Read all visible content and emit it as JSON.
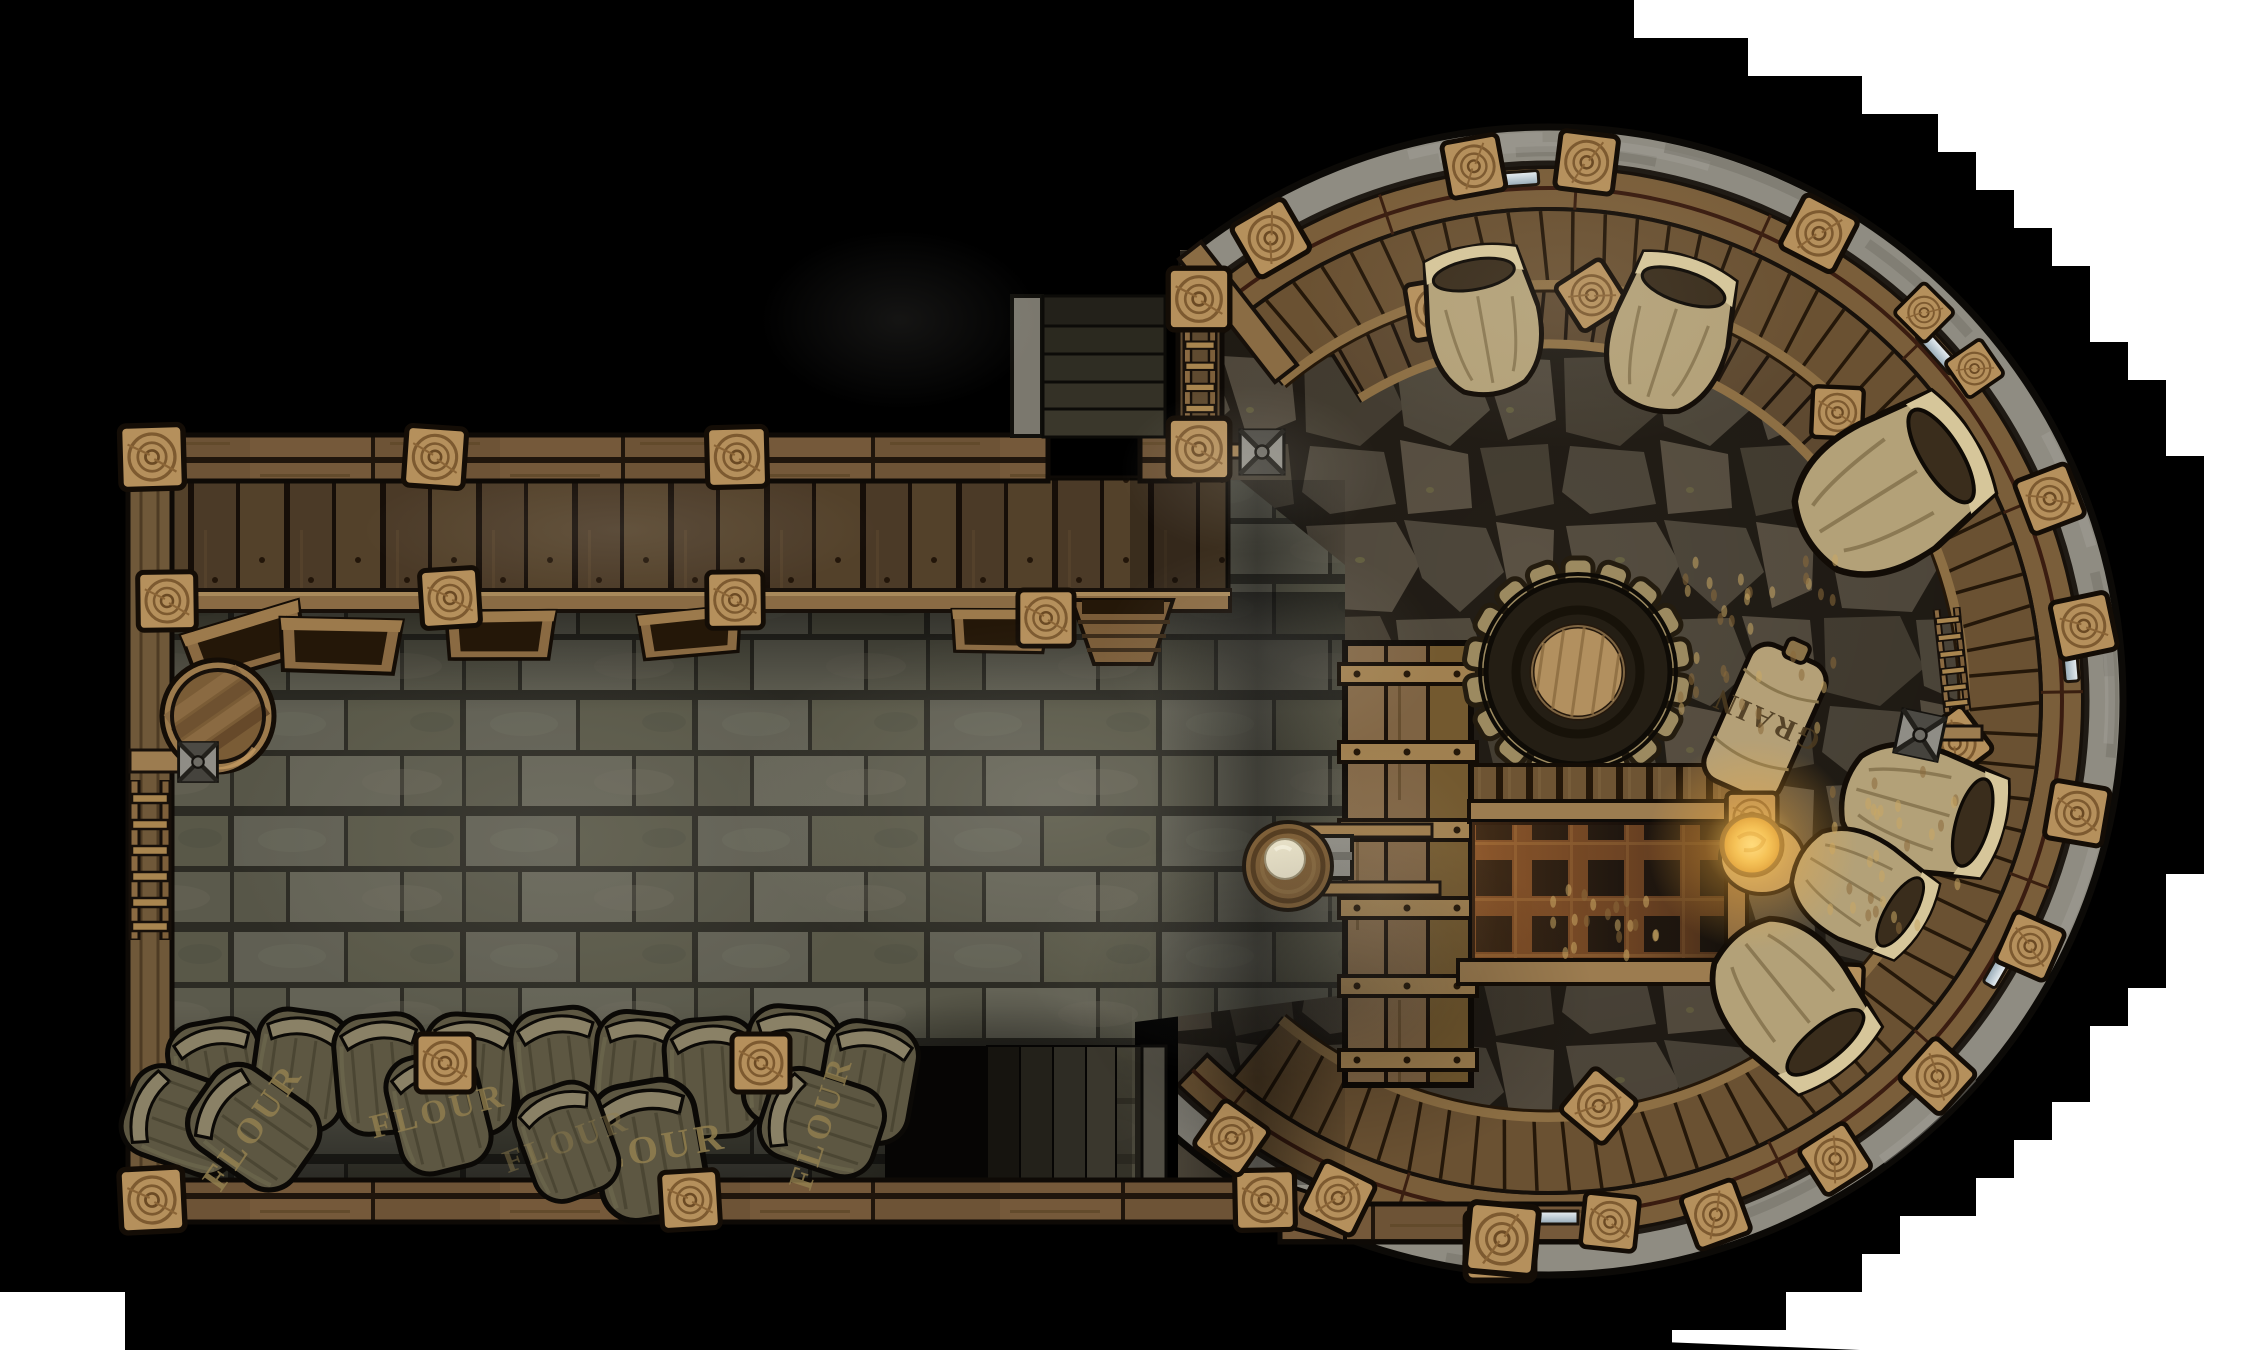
{
  "canvas": {
    "width": 2250,
    "height": 1350,
    "outside_color": "#ffffff",
    "shadow_color": "#000000"
  },
  "labels": {
    "flour": "FLOUR",
    "grain": "GRAIN"
  },
  "palette": {
    "brick_floor": "#5e5d50",
    "brick_mortar": "#2c2b24",
    "flagstone": "#4e473b",
    "flag_joint": "#221d16",
    "wood_light": "#b5905c",
    "wood_mid": "#75593a",
    "wood_dark": "#4e3b26",
    "stone_wall": "#8f8c82",
    "metal": "#8f8d86",
    "grate_rust": "#7c4e28",
    "lantern_glow": "#f5c55a",
    "sack_tan": "#b3a178",
    "flour_sack": "#5d5742",
    "flour_text": "#93804f",
    "flour_pile": "#e9e2c8"
  },
  "rooms": {
    "mill_hall": {
      "name": "rectangular mill hall",
      "features": [
        "loft-deck",
        "deck-railing",
        "open-crates",
        "storage-hopper",
        "barrel",
        "water-valve",
        "wall-ladder",
        "flour-sack-pile",
        "cellar-stairs",
        "entrance-stairs",
        "entrance-ladder"
      ]
    },
    "tower": {
      "name": "round mill tower",
      "features": [
        "curved-gallery",
        "gallery-posts",
        "arrow-slit-windows",
        "open-grain-sacks",
        "mill-gear",
        "machine-housing",
        "slat-platform",
        "floor-grate",
        "lantern",
        "grain-sack",
        "flour-chute",
        "flour-basket",
        "leaning-ladder",
        "water-valve",
        "grain-spills"
      ]
    }
  },
  "counts": {
    "flour_sacks": 12,
    "labeled_flour_sacks": 5,
    "open_sacks": 6,
    "window_slits": 5,
    "valves": 3,
    "ladders": 4,
    "wall_posts": 30
  }
}
